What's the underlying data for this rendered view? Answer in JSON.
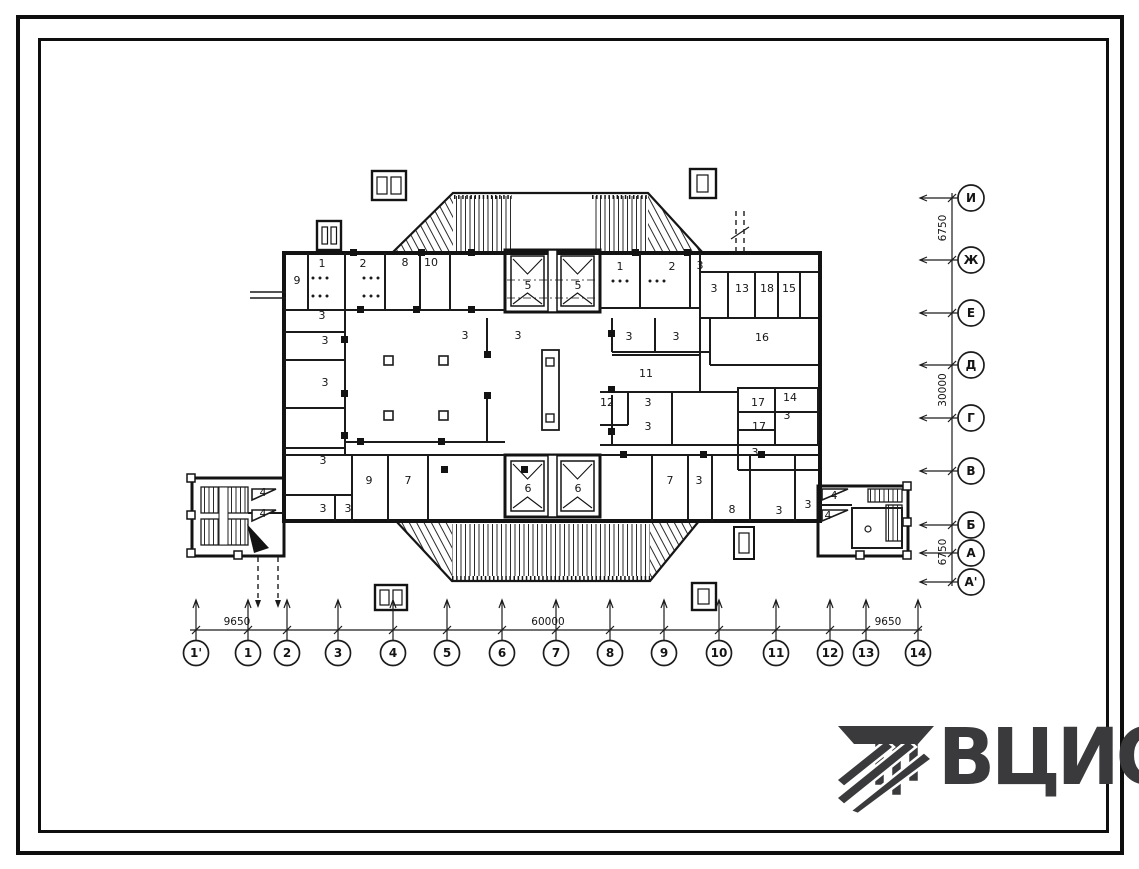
{
  "colors": {
    "ink": "#1c1c1c",
    "paper": "#ffffff",
    "logo": "#3a3a3c"
  },
  "plan": {
    "room_labels": [
      {
        "x": 297,
        "y": 284,
        "t": "9"
      },
      {
        "x": 322,
        "y": 267,
        "t": "1"
      },
      {
        "x": 363,
        "y": 267,
        "t": "2"
      },
      {
        "x": 405,
        "y": 266,
        "t": "8"
      },
      {
        "x": 431,
        "y": 266,
        "t": "10"
      },
      {
        "x": 528,
        "y": 289,
        "t": "5"
      },
      {
        "x": 578,
        "y": 289,
        "t": "5"
      },
      {
        "x": 620,
        "y": 270,
        "t": "1"
      },
      {
        "x": 672,
        "y": 270,
        "t": "2"
      },
      {
        "x": 700,
        "y": 269,
        "t": "3"
      },
      {
        "x": 714,
        "y": 292,
        "t": "3"
      },
      {
        "x": 742,
        "y": 292,
        "t": "13"
      },
      {
        "x": 767,
        "y": 292,
        "t": "18"
      },
      {
        "x": 789,
        "y": 292,
        "t": "15"
      },
      {
        "x": 322,
        "y": 319,
        "t": "3"
      },
      {
        "x": 325,
        "y": 344,
        "t": "3"
      },
      {
        "x": 465,
        "y": 339,
        "t": "3"
      },
      {
        "x": 518,
        "y": 339,
        "t": "3"
      },
      {
        "x": 629,
        "y": 340,
        "t": "3"
      },
      {
        "x": 676,
        "y": 340,
        "t": "3"
      },
      {
        "x": 762,
        "y": 341,
        "t": "16"
      },
      {
        "x": 325,
        "y": 386,
        "t": "3"
      },
      {
        "x": 646,
        "y": 377,
        "t": "11"
      },
      {
        "x": 607,
        "y": 406,
        "t": "12"
      },
      {
        "x": 648,
        "y": 406,
        "t": "3"
      },
      {
        "x": 758,
        "y": 406,
        "t": "17"
      },
      {
        "x": 790,
        "y": 401,
        "t": "14"
      },
      {
        "x": 787,
        "y": 419,
        "t": "3"
      },
      {
        "x": 759,
        "y": 430,
        "t": "17"
      },
      {
        "x": 648,
        "y": 430,
        "t": "3"
      },
      {
        "x": 323,
        "y": 464,
        "t": "3"
      },
      {
        "x": 755,
        "y": 456,
        "t": "3"
      },
      {
        "x": 369,
        "y": 484,
        "t": "9"
      },
      {
        "x": 408,
        "y": 484,
        "t": "7"
      },
      {
        "x": 323,
        "y": 512,
        "t": "3"
      },
      {
        "x": 348,
        "y": 512,
        "t": "3"
      },
      {
        "x": 528,
        "y": 492,
        "t": "6"
      },
      {
        "x": 578,
        "y": 492,
        "t": "6"
      },
      {
        "x": 670,
        "y": 484,
        "t": "7"
      },
      {
        "x": 699,
        "y": 484,
        "t": "3"
      },
      {
        "x": 732,
        "y": 513,
        "t": "8"
      },
      {
        "x": 779,
        "y": 514,
        "t": "3"
      },
      {
        "x": 808,
        "y": 508,
        "t": "3"
      },
      {
        "x": 263,
        "y": 496,
        "t": "4"
      },
      {
        "x": 263,
        "y": 517,
        "t": "4"
      },
      {
        "x": 834,
        "y": 499,
        "t": "4"
      },
      {
        "x": 828,
        "y": 519,
        "t": "4"
      }
    ]
  },
  "axes": {
    "bottom": {
      "markers": [
        {
          "x": 196,
          "label": "1'"
        },
        {
          "x": 248,
          "label": "1"
        },
        {
          "x": 287,
          "label": "2"
        },
        {
          "x": 338,
          "label": "3"
        },
        {
          "x": 393,
          "label": "4"
        },
        {
          "x": 447,
          "label": "5"
        },
        {
          "x": 502,
          "label": "6"
        },
        {
          "x": 556,
          "label": "7"
        },
        {
          "x": 610,
          "label": "8"
        },
        {
          "x": 664,
          "label": "9"
        },
        {
          "x": 719,
          "label": "10"
        },
        {
          "x": 776,
          "label": "11"
        },
        {
          "x": 830,
          "label": "12"
        },
        {
          "x": 866,
          "label": "13"
        },
        {
          "x": 918,
          "label": "14"
        }
      ],
      "dimensions": [
        {
          "x": 237,
          "text": "9650"
        },
        {
          "x": 548,
          "text": "60000"
        },
        {
          "x": 888,
          "text": "9650"
        }
      ]
    },
    "right": {
      "markers": [
        {
          "y": 198,
          "label": "И"
        },
        {
          "y": 260,
          "label": "Ж"
        },
        {
          "y": 313,
          "label": "Е"
        },
        {
          "y": 365,
          "label": "Д"
        },
        {
          "y": 418,
          "label": "Г"
        },
        {
          "y": 471,
          "label": "В"
        },
        {
          "y": 525,
          "label": "Б"
        },
        {
          "y": 553,
          "label": "А"
        },
        {
          "y": 582,
          "label": "А'"
        }
      ],
      "dimensions": [
        {
          "y": 228,
          "text": "6750"
        },
        {
          "y": 390,
          "text": "30000"
        },
        {
          "y": 552,
          "text": "6750"
        }
      ]
    }
  },
  "logo": {
    "text": "ВЦИС"
  }
}
